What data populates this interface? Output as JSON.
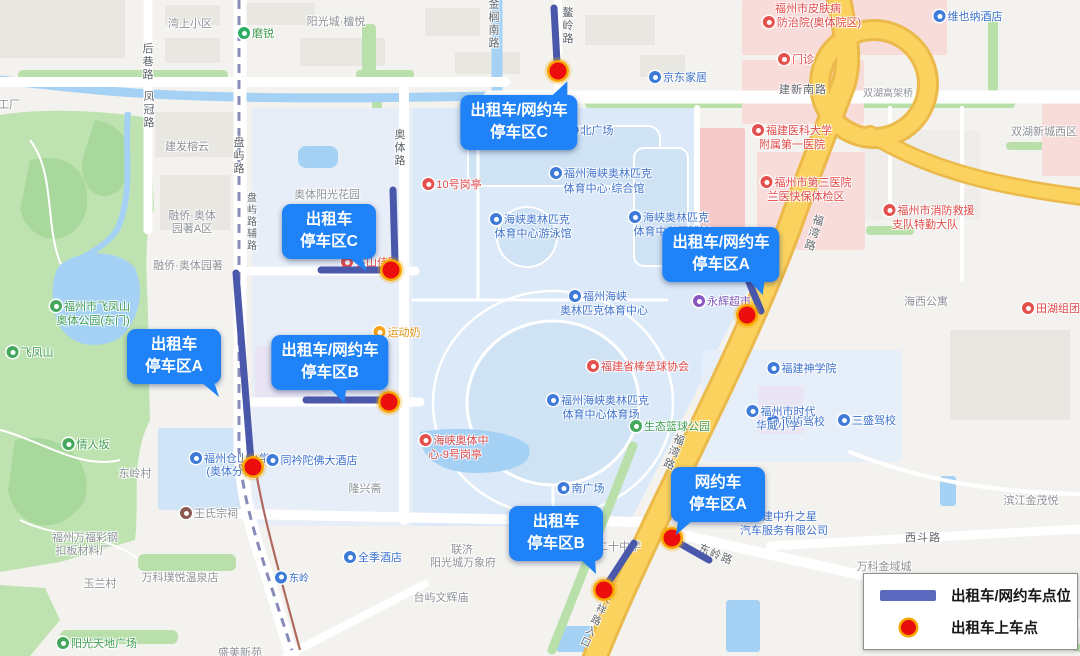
{
  "legend": {
    "line_label": "出租车/网约车点位",
    "dot_label": "出租车上车点"
  },
  "callouts": {
    "taxi_wyc_c": {
      "line1": "出租车/网约车",
      "line2": "停车区C"
    },
    "taxi_c": {
      "line1": "出租车",
      "line2": "停车区C"
    },
    "taxi_wyc_b": {
      "line1": "出租车/网约车",
      "line2": "停车区B"
    },
    "taxi_a": {
      "line1": "出租车",
      "line2": "停车区A"
    },
    "taxi_wyc_a": {
      "line1": "出租车/网约车",
      "line2": "停车区A"
    },
    "wyc_a": {
      "line1": "网约车",
      "line2": "停车区A"
    },
    "taxi_b": {
      "line1": "出租车",
      "line2": "停车区B"
    }
  },
  "colors": {
    "callout_bg": "#1f83f7",
    "parking_line": "#4a58ab",
    "pickup_dot": "#ec0d0d",
    "pickup_ring": "#f7a600",
    "expressway": "#fbd25e",
    "water": "#a5d2f4",
    "park": "#bfe3b0",
    "campus": "#dbe9f8"
  },
  "pickup_points": [
    {
      "x": 558,
      "y": 71
    },
    {
      "x": 391,
      "y": 270
    },
    {
      "x": 389,
      "y": 402
    },
    {
      "x": 253,
      "y": 467
    },
    {
      "x": 747,
      "y": 315
    },
    {
      "x": 672,
      "y": 538
    },
    {
      "x": 604,
      "y": 590
    }
  ],
  "parking_lines": [
    {
      "x1": 554,
      "y1": 8,
      "x2": 557,
      "y2": 62
    },
    {
      "x1": 393,
      "y1": 190,
      "x2": 395,
      "y2": 263
    },
    {
      "x1": 321,
      "y1": 270,
      "x2": 397,
      "y2": 270
    },
    {
      "x1": 306,
      "y1": 400,
      "x2": 381,
      "y2": 400
    },
    {
      "x1": 236,
      "y1": 273,
      "x2": 251,
      "y2": 462
    },
    {
      "x1": 749,
      "y1": 282,
      "x2": 761,
      "y2": 311
    },
    {
      "x1": 679,
      "y1": 543,
      "x2": 709,
      "y2": 560
    },
    {
      "x1": 634,
      "y1": 543,
      "x2": 606,
      "y2": 586
    }
  ],
  "map_labels": [
    {
      "t": "湾上小区",
      "x": 190,
      "y": 23,
      "k": "area"
    },
    {
      "t": "磨锐",
      "x": 256,
      "y": 33,
      "k": "green",
      "icon": "metro"
    },
    {
      "t": "阳光城·檀悦",
      "x": 336,
      "y": 21,
      "k": "area"
    },
    {
      "t": "维也纳酒店",
      "x": 968,
      "y": 16,
      "k": "blue",
      "icon": "blue"
    },
    {
      "t": "后巷路",
      "x": 147,
      "y": 62,
      "k": "road",
      "v": 1
    },
    {
      "t": "凤冠路",
      "x": 148,
      "y": 110,
      "k": "road",
      "v": 1
    },
    {
      "t": "工厂",
      "x": 9,
      "y": 104,
      "k": "area"
    },
    {
      "t": "金榈南路",
      "x": 493,
      "y": 24,
      "k": "road",
      "v": 1
    },
    {
      "t": "鳌岭路",
      "x": 567,
      "y": 26,
      "k": "road",
      "v": 1
    },
    {
      "t": "京东家居",
      "x": 678,
      "y": 77,
      "k": "blue",
      "icon": "blue"
    },
    {
      "t": "门诊",
      "x": 796,
      "y": 59,
      "k": "red",
      "icon": "red"
    },
    {
      "t": "福州市皮肤病",
      "x": 808,
      "y": 8,
      "k": "red"
    },
    {
      "t": "防治院(奥体院区)",
      "x": 812,
      "y": 22,
      "k": "red",
      "icon": "red"
    },
    {
      "t": "建新南路",
      "x": 803,
      "y": 89,
      "k": "road"
    },
    {
      "t": "双湖高架桥",
      "x": 888,
      "y": 92,
      "k": "area",
      "fs": 10
    },
    {
      "t": "双湖新城西区",
      "x": 1044,
      "y": 131,
      "k": "area"
    },
    {
      "t": "福建医科大学",
      "x": 792,
      "y": 130,
      "k": "red",
      "icon": "red"
    },
    {
      "t": "附属第一医院",
      "x": 792,
      "y": 144,
      "k": "red"
    },
    {
      "t": "福州市第三医院",
      "x": 806,
      "y": 182,
      "k": "red",
      "icon": "red"
    },
    {
      "t": "兰医快保体检区",
      "x": 806,
      "y": 196,
      "k": "red"
    },
    {
      "t": "奥体路",
      "x": 399,
      "y": 148,
      "k": "road",
      "v": 1
    },
    {
      "t": "盘屿路",
      "x": 238,
      "y": 156,
      "k": "road",
      "v": 1
    },
    {
      "t": "盘屿路辅路",
      "x": 250,
      "y": 222,
      "k": "road",
      "v": 1,
      "fs": 10
    },
    {
      "t": "建发榕云",
      "x": 187,
      "y": 146,
      "k": "area"
    },
    {
      "t": "奥体阳光花园",
      "x": 327,
      "y": 194,
      "k": "area"
    },
    {
      "t": "融侨·奥体",
      "x": 192,
      "y": 215,
      "k": "area"
    },
    {
      "t": "园著A区",
      "x": 192,
      "y": 228,
      "k": "area"
    },
    {
      "t": "融侨·奥体园著",
      "x": 188,
      "y": 265,
      "k": "area"
    },
    {
      "t": "10号岗亭",
      "x": 452,
      "y": 184,
      "k": "red",
      "icon": "red"
    },
    {
      "t": "福州海峡奥林匹克",
      "x": 601,
      "y": 173,
      "k": "campus",
      "icon": "blue"
    },
    {
      "t": "体育中心·综合馆",
      "x": 604,
      "y": 188,
      "k": "campus"
    },
    {
      "t": "海峡奥林匹克",
      "x": 530,
      "y": 219,
      "k": "campus",
      "icon": "blue"
    },
    {
      "t": "体育中心游泳馆",
      "x": 533,
      "y": 233,
      "k": "campus"
    },
    {
      "t": "海峡奥林匹克",
      "x": 669,
      "y": 217,
      "k": "campus",
      "icon": "blue"
    },
    {
      "t": "体育中心网球馆",
      "x": 672,
      "y": 231,
      "k": "campus"
    },
    {
      "t": "北广场",
      "x": 590,
      "y": 130,
      "k": "campus",
      "icon": "blue"
    },
    {
      "t": "谷山佳园",
      "x": 370,
      "y": 262,
      "k": "red",
      "icon": "red"
    },
    {
      "t": "福州海峡",
      "x": 598,
      "y": 296,
      "k": "campus",
      "icon": "blue"
    },
    {
      "t": "奥林匹克体育中心",
      "x": 604,
      "y": 310,
      "k": "campus"
    },
    {
      "t": "永辉超市",
      "x": 722,
      "y": 301,
      "k": "purple",
      "icon": "purple"
    },
    {
      "t": "福湾路",
      "x": 813,
      "y": 233,
      "k": "road",
      "v": 1,
      "rot": 18
    },
    {
      "t": "福湾路",
      "x": 673,
      "y": 452,
      "k": "road",
      "v": 1,
      "rot": 22
    },
    {
      "t": "海西公寓",
      "x": 926,
      "y": 301,
      "k": "area"
    },
    {
      "t": "田湖组团",
      "x": 1051,
      "y": 308,
      "k": "red",
      "icon": "red"
    },
    {
      "t": "福州市消防救援",
      "x": 929,
      "y": 210,
      "k": "red",
      "icon": "red"
    },
    {
      "t": "支队特勤大队",
      "x": 925,
      "y": 224,
      "k": "red"
    },
    {
      "t": "运动奶",
      "x": 397,
      "y": 332,
      "k": "orange",
      "icon": "orange"
    },
    {
      "t": "福建省棒垒球协会",
      "x": 638,
      "y": 366,
      "k": "red",
      "icon": "red"
    },
    {
      "t": "福建神学院",
      "x": 802,
      "y": 368,
      "k": "blue",
      "icon": "blue"
    },
    {
      "t": "银屿驾校",
      "x": 796,
      "y": 421,
      "k": "blue",
      "icon": "blue"
    },
    {
      "t": "三盛驾校",
      "x": 867,
      "y": 420,
      "k": "blue",
      "icon": "blue"
    },
    {
      "t": "福州海峡奥林匹克",
      "x": 598,
      "y": 400,
      "k": "campus",
      "icon": "blue"
    },
    {
      "t": "体育中心体育场",
      "x": 601,
      "y": 414,
      "k": "campus"
    },
    {
      "t": "生态篮球公园",
      "x": 670,
      "y": 426,
      "k": "green",
      "icon": "green"
    },
    {
      "t": "海峡奥体中",
      "x": 454,
      "y": 440,
      "k": "red",
      "icon": "red"
    },
    {
      "t": "心-9号岗亭",
      "x": 455,
      "y": 454,
      "k": "red"
    },
    {
      "t": "福州市飞凤山",
      "x": 90,
      "y": 306,
      "k": "green",
      "icon": "green"
    },
    {
      "t": "奥体公园(东门)",
      "x": 93,
      "y": 320,
      "k": "green"
    },
    {
      "t": "飞凤山",
      "x": 30,
      "y": 352,
      "k": "green",
      "icon": "green"
    },
    {
      "t": "情人坂",
      "x": 86,
      "y": 444,
      "k": "green",
      "icon": "green"
    },
    {
      "t": "东岭村",
      "x": 135,
      "y": 473,
      "k": "area"
    },
    {
      "t": "福州仓山小学",
      "x": 230,
      "y": 458,
      "k": "blue",
      "icon": "blue"
    },
    {
      "t": "(奥体分校)",
      "x": 232,
      "y": 471,
      "k": "blue"
    },
    {
      "t": "同衿陀佛大酒店",
      "x": 312,
      "y": 460,
      "k": "blue",
      "icon": "blue"
    },
    {
      "t": "王氏宗祠",
      "x": 209,
      "y": 513,
      "k": "area",
      "icon": "dark"
    },
    {
      "t": "福州万福彩钢",
      "x": 85,
      "y": 537,
      "k": "area"
    },
    {
      "t": "扣板材料厂",
      "x": 83,
      "y": 550,
      "k": "area"
    },
    {
      "t": "玉兰村",
      "x": 100,
      "y": 583,
      "k": "area"
    },
    {
      "t": "万科璞悦温泉店",
      "x": 180,
      "y": 577,
      "k": "area"
    },
    {
      "t": "阳光天地广场",
      "x": 97,
      "y": 643,
      "k": "green",
      "icon": "green"
    },
    {
      "t": "东岭",
      "x": 292,
      "y": 577,
      "k": "blue",
      "icon": "blue",
      "fs": 10
    },
    {
      "t": "盛美新苑",
      "x": 240,
      "y": 652,
      "k": "area"
    },
    {
      "t": "隆兴斋",
      "x": 365,
      "y": 488,
      "k": "area"
    },
    {
      "t": "全季酒店",
      "x": 373,
      "y": 557,
      "k": "blue",
      "icon": "blue"
    },
    {
      "t": "联济",
      "x": 462,
      "y": 549,
      "k": "area"
    },
    {
      "t": "阳光城万象府",
      "x": 463,
      "y": 562,
      "k": "area"
    },
    {
      "t": "台屿文辉庙",
      "x": 441,
      "y": 597,
      "k": "area"
    },
    {
      "t": "南广场",
      "x": 581,
      "y": 488,
      "k": "campus",
      "icon": "blue"
    },
    {
      "t": "二十中学",
      "x": 619,
      "y": 546,
      "k": "area"
    },
    {
      "t": "福州市时代",
      "x": 781,
      "y": 411,
      "k": "blue",
      "icon": "blue"
    },
    {
      "t": "华威小学",
      "x": 778,
      "y": 425,
      "k": "blue"
    },
    {
      "t": "福建中升之星",
      "x": 777,
      "y": 516,
      "k": "blue",
      "icon": "blue"
    },
    {
      "t": "汽车服务有限公司",
      "x": 784,
      "y": 530,
      "k": "blue"
    },
    {
      "t": "天祥路入口",
      "x": 594,
      "y": 620,
      "k": "road",
      "v": 1,
      "rot": 25,
      "fs": 10
    },
    {
      "t": "东岭路",
      "x": 716,
      "y": 554,
      "k": "road",
      "rot": 22
    },
    {
      "t": "东岭路",
      "x": 1062,
      "y": 622,
      "k": "road",
      "v": 1
    },
    {
      "t": "西斗路",
      "x": 923,
      "y": 537,
      "k": "road"
    },
    {
      "t": "滨江金茂悦",
      "x": 1031,
      "y": 500,
      "k": "area"
    },
    {
      "t": "万科金域城",
      "x": 884,
      "y": 566,
      "k": "area"
    }
  ]
}
